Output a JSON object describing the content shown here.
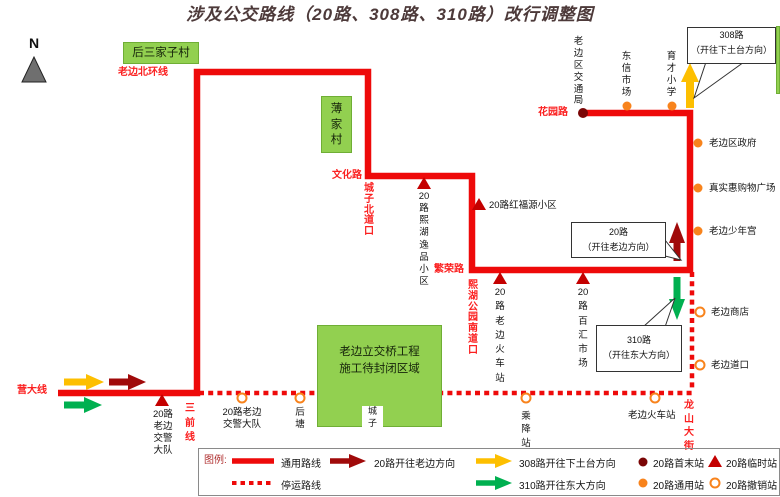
{
  "title": "涉及公交路线（20路、308路、310路）改行调整图",
  "colors": {
    "route": "#ee0a0a",
    "label_red": "#fb2020",
    "dark_red": "#a00a0a",
    "terminal": "#7a0505",
    "triangle": "#c40000",
    "orange": "#f8831c",
    "yellow": "#fdbf00",
    "green": "#00b050",
    "area": "#92d050",
    "title": "#4d3a3a"
  },
  "compass": {
    "label": "N"
  },
  "areas": {
    "hou_san_jia_zi": "后三家子村",
    "bo_jia_cun": "薄\n家\n村",
    "construction": "老边立交桥工程\n施工待封闭区域"
  },
  "roads": {
    "laobian_beihuan": "老边北环线",
    "wenhua": "文化路",
    "chengzi_beidaokou": "城\n子\n北\n道\n口",
    "fanrong": "繁荣路",
    "xihu_gongyuan_nandaokou": "熙\n湖\n公\n园\n南\n道\n口",
    "huayuan": "花园路",
    "yingda": "营大线",
    "sanqian": "三\n前\n线",
    "longshan": "龙\n山\n大\n街"
  },
  "stations": {
    "jiaotongju": "老\n边\n区\n交\n通\n局",
    "dongxin": "东\n信\n市\n场",
    "yucai": "育\n才\n小\n学",
    "quzhengfu": "老边区政府",
    "zhenshihui": "真实惠购物广场",
    "shaoniangong": "老边少年宫",
    "shangdian": "老边商店",
    "daokou": "老边道口",
    "xihu_yipin": "20\n路\n熙\n湖\n逸\n品\n小\n区",
    "hongfuyuan": "20路红福源小区",
    "huochezhan_20": "20\n路\n老\n边\n火\n车\n站",
    "baihui": "20\n路\n百\n汇\n市\n场",
    "jiaojing_temp": "20路\n老边\n交警\n大队",
    "jiaojing_cancel": "20路老边\n交警大队",
    "houtang": "后\n塘",
    "chengzi": "城\n子",
    "chengjiang": "乘\n降\n站",
    "huochezhan_cancel": "老边火车站"
  },
  "callouts": {
    "c308": "308路\n（开往下土台方向）",
    "c20": "20路\n（开往老边方向）",
    "c310": "310路\n（开往东大方向）"
  },
  "legend": {
    "title": "图例:",
    "solid": "通用路线",
    "dotted": "停运路线",
    "arrow20": "20路开往老边方向",
    "arrow308": "308路开往下土台方向",
    "arrow310": "310路开往东大方向",
    "terminal": "20路首末站",
    "temporary": "20路临时站",
    "general": "20路通用站",
    "cancelled": "20路撤销站"
  }
}
